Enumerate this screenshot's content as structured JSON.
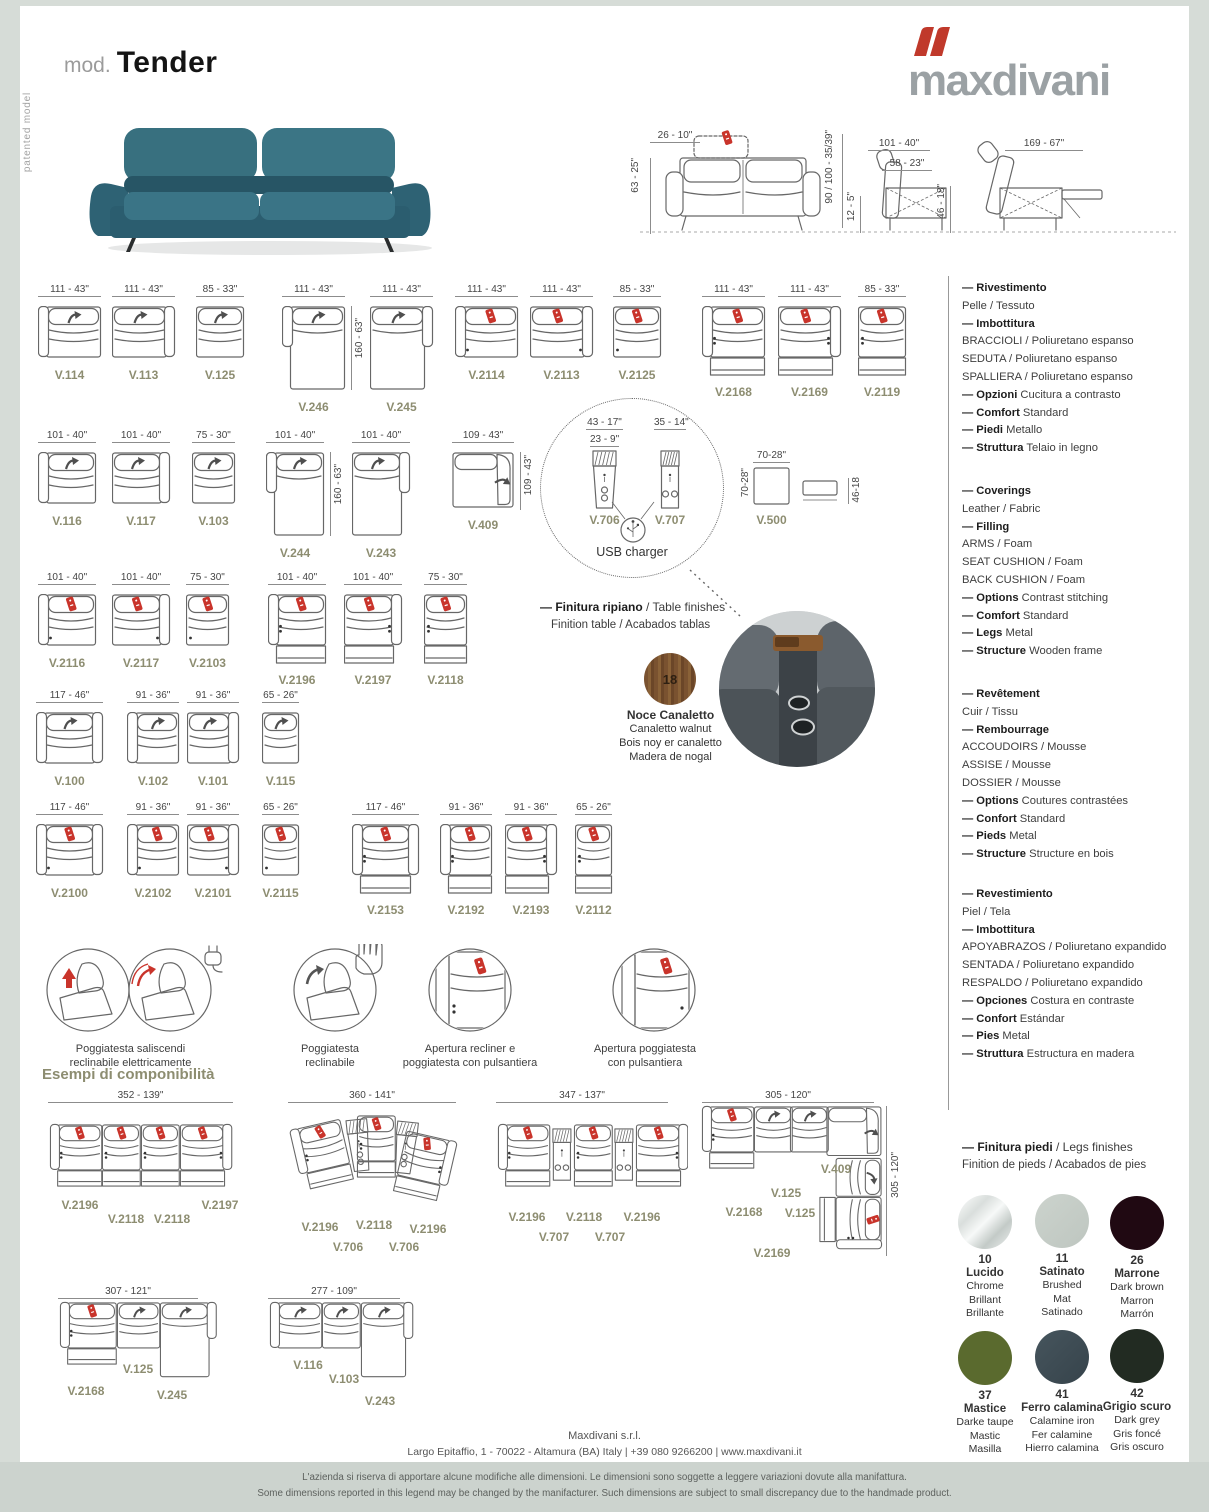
{
  "header": {
    "mod_label": "mod.",
    "model_name": "Tender",
    "patented_label": "patented model",
    "brand": "maxdivani"
  },
  "overview": {
    "front": {
      "headrest": "26 - 10\"",
      "height": "63 - 25\"",
      "total_height": "90 / 100  - 35/39\"",
      "seat_height": "12 - 5\""
    },
    "side": {
      "depth": "101 - 40\"",
      "seat_depth": "58 - 23\"",
      "seat_h": "46 - 18\""
    },
    "reclined": {
      "depth": "169 - 67\""
    }
  },
  "modules": [
    {
      "id": "V.114",
      "dim": "111 - 43\"",
      "arm": "l",
      "icon": "grey",
      "dots": 0,
      "ext": false,
      "kind": "seat",
      "vdim": ""
    },
    {
      "id": "V.113",
      "dim": "111 - 43\"",
      "arm": "r",
      "icon": "grey",
      "dots": 0,
      "ext": false,
      "kind": "seat",
      "vdim": ""
    },
    {
      "id": "V.125",
      "dim": "85 - 33\"",
      "arm": "n",
      "icon": "grey",
      "dots": 0,
      "ext": false,
      "kind": "seat",
      "vdim": ""
    },
    {
      "id": "V.246",
      "dim": "111 - 43\"",
      "arm": "l",
      "icon": "grey",
      "dots": 0,
      "ext": false,
      "kind": "chaise",
      "vdim": "160 - 63\""
    },
    {
      "id": "V.245",
      "dim": "111 - 43\"",
      "arm": "r",
      "icon": "grey",
      "dots": 0,
      "ext": false,
      "kind": "chaise",
      "vdim": ""
    },
    {
      "id": "V.2114",
      "dim": "111 - 43\"",
      "arm": "l",
      "icon": "red",
      "dots": 1,
      "ext": false,
      "kind": "seat",
      "vdim": ""
    },
    {
      "id": "V.2113",
      "dim": "111 - 43\"",
      "arm": "r",
      "icon": "red",
      "dots": 1,
      "ext": false,
      "kind": "seat",
      "vdim": ""
    },
    {
      "id": "V.2125",
      "dim": "85 - 33\"",
      "arm": "n",
      "icon": "red",
      "dots": 1,
      "ext": false,
      "kind": "seat",
      "vdim": ""
    },
    {
      "id": "V.2168",
      "dim": "111 - 43\"",
      "arm": "l",
      "icon": "red",
      "dots": 2,
      "ext": true,
      "kind": "seat",
      "vdim": ""
    },
    {
      "id": "V.2169",
      "dim": "111 - 43\"",
      "arm": "r",
      "icon": "red",
      "dots": 2,
      "ext": true,
      "kind": "seat",
      "vdim": ""
    },
    {
      "id": "V.2119",
      "dim": "85 - 33\"",
      "arm": "n",
      "icon": "red",
      "dots": 2,
      "ext": true,
      "kind": "seat",
      "vdim": ""
    },
    {
      "id": "V.116",
      "dim": "101 - 40\"",
      "arm": "l",
      "icon": "grey",
      "dots": 0,
      "ext": false,
      "kind": "seat",
      "vdim": ""
    },
    {
      "id": "V.117",
      "dim": "101 - 40\"",
      "arm": "r",
      "icon": "grey",
      "dots": 0,
      "ext": false,
      "kind": "seat",
      "vdim": ""
    },
    {
      "id": "V.103",
      "dim": "75 - 30\"",
      "arm": "n",
      "icon": "grey",
      "dots": 0,
      "ext": false,
      "kind": "seat",
      "vdim": ""
    },
    {
      "id": "V.244",
      "dim": "101 - 40\"",
      "arm": "l",
      "icon": "grey",
      "dots": 0,
      "ext": false,
      "kind": "chaise",
      "vdim": "160 - 63\""
    },
    {
      "id": "V.243",
      "dim": "101 - 40\"",
      "arm": "r",
      "icon": "grey",
      "dots": 0,
      "ext": false,
      "kind": "chaise",
      "vdim": ""
    },
    {
      "id": "V.409",
      "dim": "109 - 43\"",
      "arm": "r",
      "icon": "grey",
      "dots": 0,
      "ext": false,
      "kind": "corner",
      "vdim": "109 - 43\""
    },
    {
      "id": "V.706",
      "dim": "43 - 17\"",
      "dim2": "23 - 9\"",
      "kind": "console"
    },
    {
      "id": "V.707",
      "dim": "35 - 14\"",
      "kind": "console"
    },
    {
      "id": "V.500",
      "dim": "70-28\"",
      "vdim": "70-28\"",
      "side_dim": "46-18",
      "kind": "pouf"
    },
    {
      "id": "V.2116",
      "dim": "101 - 40\"",
      "arm": "l",
      "icon": "red",
      "dots": 1,
      "ext": false,
      "kind": "seat",
      "vdim": ""
    },
    {
      "id": "V.2117",
      "dim": "101 - 40\"",
      "arm": "r",
      "icon": "red",
      "dots": 1,
      "ext": false,
      "kind": "seat",
      "vdim": ""
    },
    {
      "id": "V.2103",
      "dim": "75 - 30\"",
      "arm": "n",
      "icon": "red",
      "dots": 1,
      "ext": false,
      "kind": "seat",
      "vdim": ""
    },
    {
      "id": "V.2196",
      "dim": "101 - 40\"",
      "arm": "l",
      "icon": "red",
      "dots": 2,
      "ext": true,
      "kind": "seat",
      "vdim": ""
    },
    {
      "id": "V.2197",
      "dim": "101 - 40\"",
      "arm": "r",
      "icon": "red",
      "dots": 2,
      "ext": true,
      "kind": "seat",
      "vdim": ""
    },
    {
      "id": "V.2118",
      "dim": "75 - 30\"",
      "arm": "n",
      "icon": "red",
      "dots": 2,
      "ext": true,
      "kind": "seat",
      "vdim": ""
    },
    {
      "id": "V.100",
      "dim": "117 - 46\"",
      "arm": "b",
      "icon": "grey",
      "dots": 0,
      "ext": false,
      "kind": "seat",
      "vdim": ""
    },
    {
      "id": "V.102",
      "dim": "91 - 36\"",
      "arm": "l",
      "icon": "grey",
      "dots": 0,
      "ext": false,
      "kind": "seat",
      "vdim": ""
    },
    {
      "id": "V.101",
      "dim": "91 - 36\"",
      "arm": "r",
      "icon": "grey",
      "dots": 0,
      "ext": false,
      "kind": "seat",
      "vdim": ""
    },
    {
      "id": "V.115",
      "dim": "65 - 26\"",
      "arm": "n",
      "icon": "grey",
      "dots": 0,
      "ext": false,
      "kind": "seat",
      "vdim": ""
    },
    {
      "id": "V.2100",
      "dim": "117 - 46\"",
      "arm": "b",
      "icon": "red",
      "dots": 1,
      "ext": false,
      "kind": "seat",
      "vdim": ""
    },
    {
      "id": "V.2102",
      "dim": "91 - 36\"",
      "arm": "l",
      "icon": "red",
      "dots": 1,
      "ext": false,
      "kind": "seat",
      "vdim": ""
    },
    {
      "id": "V.2101",
      "dim": "91 - 36\"",
      "arm": "r",
      "icon": "red",
      "dots": 1,
      "ext": false,
      "kind": "seat",
      "vdim": ""
    },
    {
      "id": "V.2115",
      "dim": "65 - 26\"",
      "arm": "n",
      "icon": "red",
      "dots": 1,
      "ext": false,
      "kind": "seat",
      "vdim": ""
    },
    {
      "id": "V.2153",
      "dim": "117 - 46\"",
      "arm": "b",
      "icon": "red",
      "dots": 2,
      "ext": true,
      "kind": "seat",
      "vdim": ""
    },
    {
      "id": "V.2192",
      "dim": "91 - 36\"",
      "arm": "l",
      "icon": "red",
      "dots": 2,
      "ext": true,
      "kind": "seat",
      "vdim": ""
    },
    {
      "id": "V.2193",
      "dim": "91 - 36\"",
      "arm": "r",
      "icon": "red",
      "dots": 2,
      "ext": true,
      "kind": "seat",
      "vdim": ""
    },
    {
      "id": "V.2112",
      "dim": "65 - 26\"",
      "arm": "n",
      "icon": "red",
      "dots": 2,
      "ext": true,
      "kind": "seat",
      "vdim": ""
    }
  ],
  "usb": {
    "label": "USB charger"
  },
  "table_finish": {
    "title_bold": "— Finitura ripiano",
    "title_rest": " / Table finishes",
    "subtitle": "Finition table / Acabados tablas",
    "swatch_number": "18",
    "names": [
      "Noce Canaletto",
      "Canaletto walnut",
      "Bois noy er canaletto",
      "Madera de nogal"
    ]
  },
  "specs": [
    {
      "lines": [
        {
          "b": "— Rivestimento",
          "t": ""
        },
        {
          "b": "",
          "t": "Pelle / Tessuto"
        },
        {
          "b": "— Imbottitura",
          "t": ""
        },
        {
          "b": "",
          "t": "BRACCIOLI / Poliuretano espanso"
        },
        {
          "b": "",
          "t": "SEDUTA / Poliuretano espanso"
        },
        {
          "b": "",
          "t": "SPALLIERA / Poliuretano espanso"
        },
        {
          "b": "— Opzioni",
          "t": " Cucitura a contrasto"
        },
        {
          "b": "— Comfort",
          "t": " Standard"
        },
        {
          "b": "— Piedi",
          "t": " Metallo"
        },
        {
          "b": "— Struttura",
          "t": " Telaio in legno"
        }
      ]
    },
    {
      "lines": [
        {
          "b": "— Coverings",
          "t": ""
        },
        {
          "b": "",
          "t": "Leather / Fabric"
        },
        {
          "b": "— Filling",
          "t": ""
        },
        {
          "b": "",
          "t": "ARMS / Foam"
        },
        {
          "b": "",
          "t": "SEAT CUSHION / Foam"
        },
        {
          "b": "",
          "t": "BACK CUSHION / Foam"
        },
        {
          "b": "— Options",
          "t": " Contrast stitching"
        },
        {
          "b": "— Comfort",
          "t": " Standard"
        },
        {
          "b": "— Legs",
          "t": " Metal"
        },
        {
          "b": "— Structure",
          "t": " Wooden frame"
        }
      ]
    },
    {
      "lines": [
        {
          "b": "— Revêtement",
          "t": ""
        },
        {
          "b": "",
          "t": "Cuir / Tissu"
        },
        {
          "b": "— Rembourrage",
          "t": ""
        },
        {
          "b": "",
          "t": "ACCOUDOIRS / Mousse"
        },
        {
          "b": "",
          "t": "ASSISE / Mousse"
        },
        {
          "b": "",
          "t": "DOSSIER / Mousse"
        },
        {
          "b": "— Options",
          "t": " Coutures contrastées"
        },
        {
          "b": "— Confort",
          "t": " Standard"
        },
        {
          "b": "— Pieds",
          "t": " Metal"
        },
        {
          "b": "— Structure",
          "t": " Structure en bois"
        }
      ]
    },
    {
      "lines": [
        {
          "b": "— Revestimiento",
          "t": ""
        },
        {
          "b": "",
          "t": "Piel / Tela"
        },
        {
          "b": "— Imbottitura",
          "t": ""
        },
        {
          "b": "",
          "t": "APOYABRAZOS / Poliuretano expandido"
        },
        {
          "b": "",
          "t": "SENTADA / Poliuretano expandido"
        },
        {
          "b": "",
          "t": "RESPALDO / Poliuretano expandido"
        },
        {
          "b": "— Opciones",
          "t": " Costura en contraste"
        },
        {
          "b": "— Confort",
          "t": " Estándar"
        },
        {
          "b": "— Pies",
          "t": " Metal"
        },
        {
          "b": "— Struttura",
          "t": " Estructura en madera"
        }
      ]
    }
  ],
  "features": [
    {
      "type": "headrest-electric",
      "lines": [
        "Poggiatesta saliscendi",
        "reclinabile elettricamente"
      ]
    },
    {
      "type": "headrest-manual",
      "lines": [
        "Poggiatesta",
        "reclinabile"
      ]
    },
    {
      "type": "recliner-buttons",
      "lines": [
        "Apertura recliner e",
        "poggiatesta con pulsantiera"
      ]
    },
    {
      "type": "headrest-buttons",
      "lines": [
        "Apertura poggiatesta",
        "con pulsantiera"
      ]
    }
  ],
  "examples_title": "Esempi di componibilità",
  "compositions": [
    {
      "id": "c1",
      "width": "352 - 139\"",
      "vheight": "",
      "modules": [
        "V.2196",
        "V.2118",
        "V.2118",
        "V.2197"
      ]
    },
    {
      "id": "c2",
      "width": "360 - 141\"",
      "vheight": "",
      "modules": [
        "V.2196",
        "V.2118",
        "V.2196",
        "V.706",
        "V.706"
      ]
    },
    {
      "id": "c3",
      "width": "347 - 137\"",
      "vheight": "",
      "modules": [
        "V.2196",
        "V.2118",
        "V.2196",
        "V.707",
        "V.707"
      ]
    },
    {
      "id": "c4",
      "width": "305 - 120\"",
      "vheight": "305 - 120\"",
      "modules": [
        "V.2168",
        "V.125",
        "V.125",
        "V.409",
        "V.2169"
      ]
    },
    {
      "id": "c5",
      "width": "307 - 121\"",
      "vheight": "",
      "modules": [
        "V.2168",
        "V.125",
        "V.245"
      ]
    },
    {
      "id": "c6",
      "width": "277 - 109\"",
      "vheight": "",
      "modules": [
        "V.116",
        "V.103",
        "V.243"
      ]
    }
  ],
  "legs_finishes": {
    "title_bold": "— Finitura piedi",
    "title_rest": " / Legs finishes",
    "subtitle": "Finition de pieds / Acabados de pies",
    "swatches": [
      {
        "num": "10",
        "names": [
          "Lucido",
          "Chrome",
          "Brillant",
          "Brillante"
        ],
        "css": "linear-gradient(135deg,#ffffff 0%,#d9dedc 30%,#f7f9f8 50%,#c3cac7 72%,#eef1f0 100%)"
      },
      {
        "num": "11",
        "names": [
          "Satinato",
          "Brushed",
          "Mat",
          "Satinado"
        ],
        "css": "linear-gradient(135deg,#ccd3cd,#bec6c0)"
      },
      {
        "num": "26",
        "names": [
          "Marrone",
          "Dark brown",
          "Marron",
          "Marrón"
        ],
        "css": "#200912"
      },
      {
        "num": "37",
        "names": [
          "Mastice",
          "Darke taupe",
          "Mastic",
          "Masilla"
        ],
        "css": "#5a6a2e"
      },
      {
        "num": "41",
        "names": [
          "Ferro calamina",
          "Calamine iron",
          "Fer calamine",
          "Hierro calamina"
        ],
        "css": "linear-gradient(135deg,#46555d,#36434b)"
      },
      {
        "num": "42",
        "names": [
          "Grigio scuro",
          "Dark grey",
          "Gris foncé",
          "Gris oscuro"
        ],
        "css": "#222b22"
      }
    ]
  },
  "footer": {
    "company": "Maxdivani s.r.l.",
    "address": "Largo Epitaffio, 1 - 70022 - Altamura (BA) Italy  |  +39 080 9266200  |  www.maxdivani.it",
    "disclaimer_it": "L'azienda si riserva di apportare alcune modifiche alle dimensioni. Le dimensioni sono soggette a leggere variazioni dovute alla manifattura.",
    "disclaimer_en": "Some dimensions reported in this legend may be changed by the manifacturer. Such dimensions are subject to small discrepancy due to the handmade product."
  },
  "colors": {
    "accent_red": "#c9342b",
    "label_olive": "#8d8d71",
    "frame_grey": "#d6dcd7",
    "sofa_teal": "#38707f"
  }
}
